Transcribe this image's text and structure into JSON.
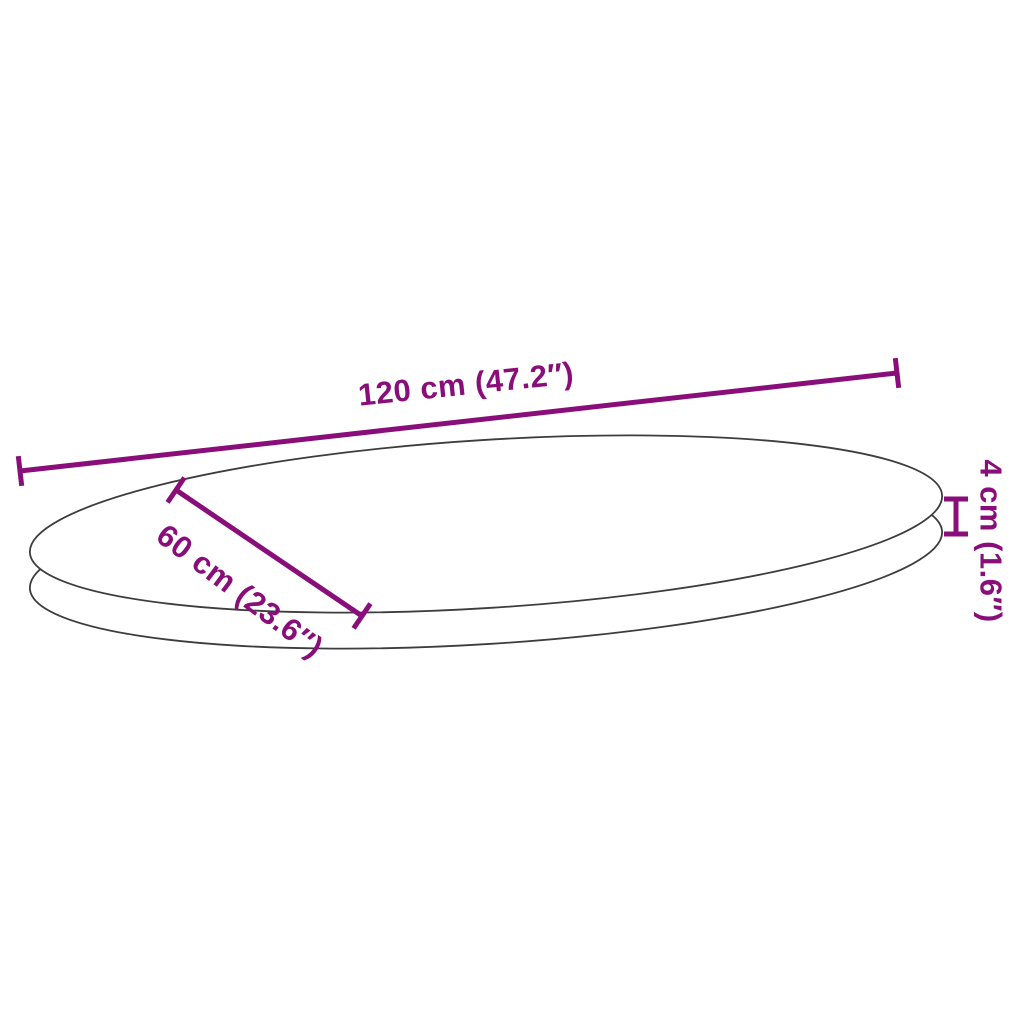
{
  "diagram": {
    "subject": "oval-table-top",
    "dimensions": {
      "length": {
        "label": "120 cm (47.2″)",
        "value_cm": 120,
        "value_in": 47.2
      },
      "width": {
        "label": "60 cm (23.6″)",
        "value_cm": 60,
        "value_in": 23.6
      },
      "thickness": {
        "label": "4 cm (1.6″)",
        "value_cm": 4,
        "value_in": 1.6
      }
    },
    "colors": {
      "dimension_accent": "#8a0e79",
      "outline": "#3d3d3d",
      "background": "#ffffff",
      "surface_fill": "#ffffff"
    }
  }
}
